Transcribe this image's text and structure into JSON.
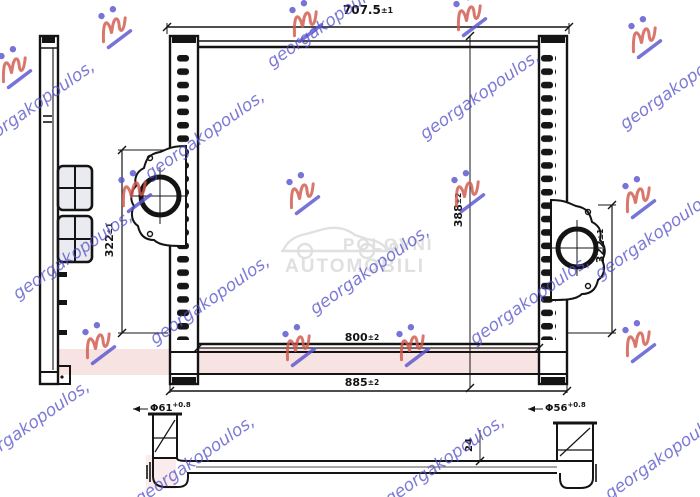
{
  "title": "intercooler-technical-drawing",
  "watermarks": {
    "name": "georgakopoulos,",
    "center": {
      "line1": "POLOVNI",
      "line2": "AUTOMOBILI"
    },
    "colors": {
      "blue": "#524ec8",
      "red": "#d15a4e",
      "gray": "#e0e0e0",
      "pink": "#f6d9d9"
    }
  },
  "dims": {
    "top": {
      "v": "707.5",
      "t": "±1"
    },
    "core_w": {
      "v": "800",
      "t": "±2"
    },
    "overall_w": {
      "v": "885",
      "t": "±2"
    },
    "left_h": {
      "v": "322",
      "t": "±1"
    },
    "mid_h": {
      "v": "388",
      "t": "±2"
    },
    "right_h": {
      "v": "322",
      "t": "±1"
    },
    "depth": {
      "v": "24"
    },
    "port_left": {
      "v": "Φ61",
      "t": "+0.8"
    },
    "port_right": {
      "v": "Φ56",
      "t": "+0.8"
    }
  }
}
